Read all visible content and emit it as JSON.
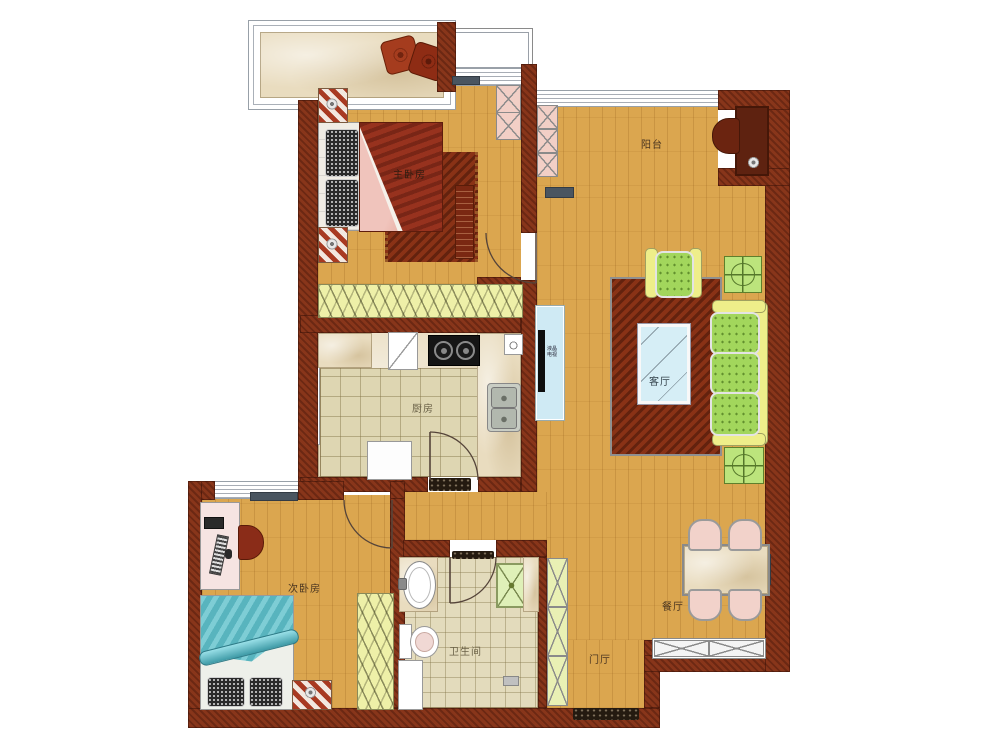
{
  "plan": {
    "rooms": {
      "master_bedroom": "主卧房",
      "balcony": "阳台",
      "living_room": "客厅",
      "kitchen": "厨房",
      "second_bedroom": "次卧房",
      "bathroom": "卫生间",
      "dining_room": "餐厅",
      "entry_hall": "门厅"
    },
    "appliances": {
      "tv": "液晶电视"
    },
    "colors": {
      "wall": "#7e2e16",
      "wood_floor": "#dba64f",
      "marble": "#e9dcbf",
      "rug": "#7c2a12",
      "sofa_cushion": "#a2d65c",
      "sofa_frame": "#eeee8a",
      "closet_fill": "#eef0a8",
      "cabinet_pink": "#f2cfc6",
      "cabinet_green": "#e9f0b4",
      "master_blanket": "#8e2c1a",
      "second_blanket": "#62c2cc",
      "glass_table": "#d6eef6"
    }
  }
}
